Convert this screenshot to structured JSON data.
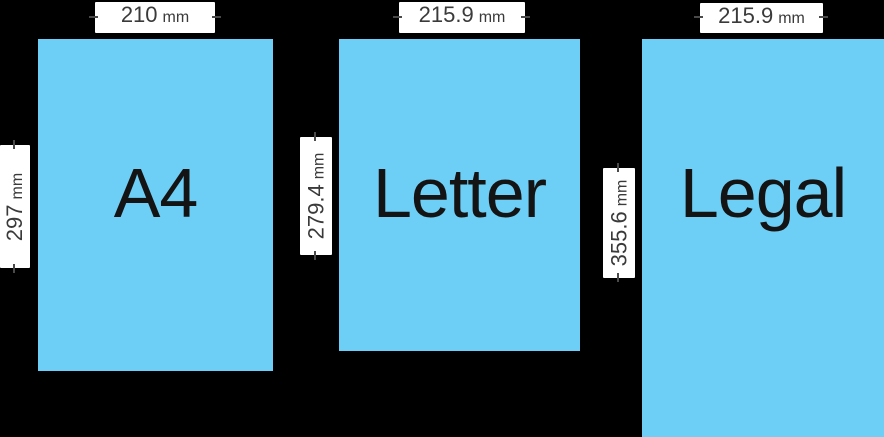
{
  "colors": {
    "background": "#000000",
    "paper_fill": "#6DCFF6",
    "label_background": "#FFFFFF",
    "label_text": "#3A3A3A",
    "paper_name_text": "#141414",
    "dimension_tick": "#4A4A4A"
  },
  "papers": [
    {
      "name": "A4",
      "width_value": "210",
      "width_unit": "mm",
      "height_value": "297",
      "height_unit": "mm"
    },
    {
      "name": "Letter",
      "width_value": "215.9",
      "width_unit": "mm",
      "height_value": "279.4",
      "height_unit": "mm"
    },
    {
      "name": "Legal",
      "width_value": "215.9",
      "width_unit": "mm",
      "height_value": "355.6",
      "height_unit": "mm"
    }
  ]
}
